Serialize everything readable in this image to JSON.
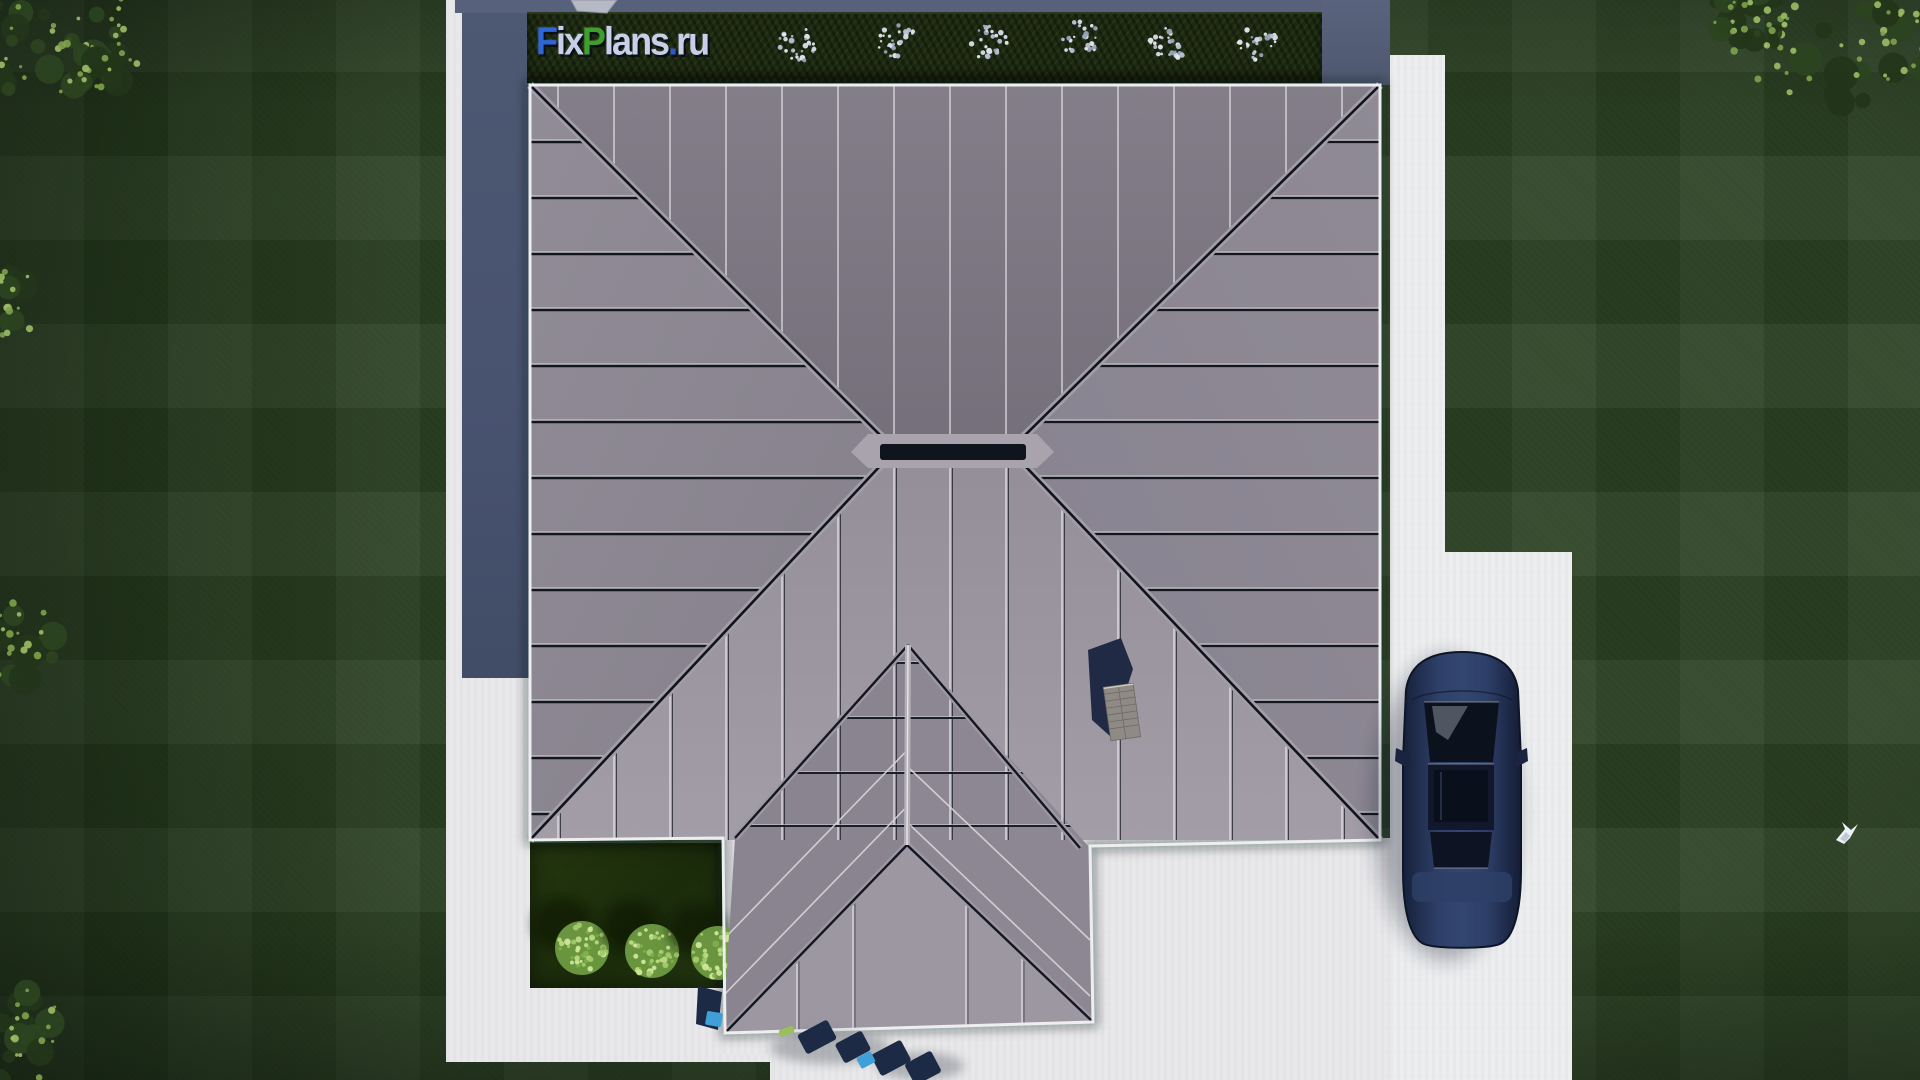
{
  "watermark": {
    "label": "FixPlans.ru",
    "segments": [
      {
        "text": "F",
        "color": "#2e66d8"
      },
      {
        "text": "ix",
        "color": "#c7d0e8"
      },
      {
        "text": "P",
        "color": "#3ea02c"
      },
      {
        "text": "lans",
        "color": "#c7d0e8"
      },
      {
        "text": ".",
        "color": "#2b57cf"
      },
      {
        "text": "ru",
        "color": "#c7d0e8"
      }
    ]
  },
  "palette": {
    "lawn": "#2c4223",
    "concrete": "#e8e8ea",
    "driveway": "#ecedef",
    "hedge": "#1d2a11",
    "wall_shadow_band": "#4a5570",
    "roof_north": "#7c7782",
    "roof_west": "#8b8691",
    "roof_east": "#8d8893",
    "roof_south": "#9c96a0",
    "wing_west": "#8a8490",
    "wing_east": "#8d8793",
    "wing_south": "#9d97a1",
    "seam_dark": "#171a24",
    "seam_light": "#d9d7dd",
    "fascia": "#f0f0f2",
    "car_body": "#223257",
    "car_glass": "#0c111e",
    "furniture_navy": "#1c2a45",
    "furniture_blue": "#3f9fd8",
    "bush_light": "#a6cc70",
    "flower_white": "#d9dee9",
    "chimney_shadow": "#202a44",
    "chimney_brick": "#8f8a85"
  },
  "scene": {
    "type": "aerial-3d-render",
    "subject": "top-down view of a single-family house hip roof with yard",
    "objects": [
      {
        "name": "main-hip-roof"
      },
      {
        "name": "entrance-wing-roof"
      },
      {
        "name": "chimney"
      },
      {
        "name": "parked-car",
        "color_desc": "dark navy blue sedan"
      },
      {
        "name": "driveway"
      },
      {
        "name": "walkway"
      },
      {
        "name": "hedge-with-flowers",
        "flower_cluster_count": 6
      },
      {
        "name": "garden-bed",
        "bush_count": 3
      },
      {
        "name": "patio-furniture"
      },
      {
        "name": "flying-bird"
      },
      {
        "name": "corner-trees"
      }
    ]
  }
}
